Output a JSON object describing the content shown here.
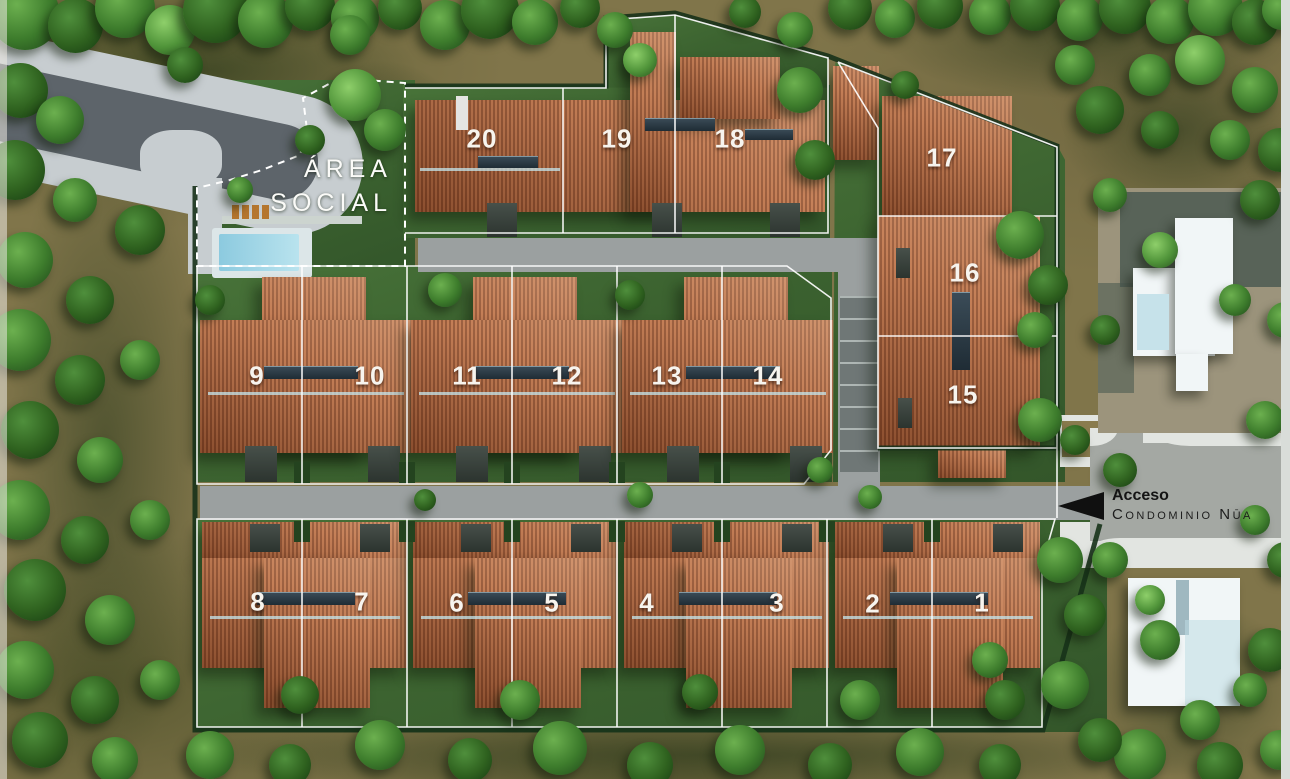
{
  "labels": {
    "area_social_line1": "ÁREA",
    "area_social_line2": "SOCIAL",
    "access_primary": "Acceso",
    "access_secondary": "Condominio Nūa"
  },
  "lots": [
    {
      "number": "1",
      "x": 982,
      "y": 603
    },
    {
      "number": "2",
      "x": 873,
      "y": 604
    },
    {
      "number": "3",
      "x": 777,
      "y": 603
    },
    {
      "number": "4",
      "x": 647,
      "y": 603
    },
    {
      "number": "5",
      "x": 552,
      "y": 603
    },
    {
      "number": "6",
      "x": 457,
      "y": 603
    },
    {
      "number": "7",
      "x": 362,
      "y": 602
    },
    {
      "number": "8",
      "x": 258,
      "y": 602
    },
    {
      "number": "9",
      "x": 257,
      "y": 376
    },
    {
      "number": "10",
      "x": 370,
      "y": 376
    },
    {
      "number": "11",
      "x": 467,
      "y": 376
    },
    {
      "number": "12",
      "x": 567,
      "y": 376
    },
    {
      "number": "13",
      "x": 667,
      "y": 376
    },
    {
      "number": "14",
      "x": 768,
      "y": 376
    },
    {
      "number": "15",
      "x": 963,
      "y": 395
    },
    {
      "number": "16",
      "x": 965,
      "y": 273
    },
    {
      "number": "17",
      "x": 942,
      "y": 158
    },
    {
      "number": "18",
      "x": 730,
      "y": 139
    },
    {
      "number": "19",
      "x": 617,
      "y": 139
    },
    {
      "number": "20",
      "x": 482,
      "y": 139
    }
  ],
  "colors": {
    "roof_terracotta": "#a8603c",
    "grass": "#3f6b33",
    "terrain_olive": "#80754a",
    "road_gray": "#9ba0a0",
    "concrete_light": "#dfe3df",
    "pool_blue": "#9fd4e4",
    "lot_line": "#ffffff",
    "arrow_black": "#101010"
  }
}
